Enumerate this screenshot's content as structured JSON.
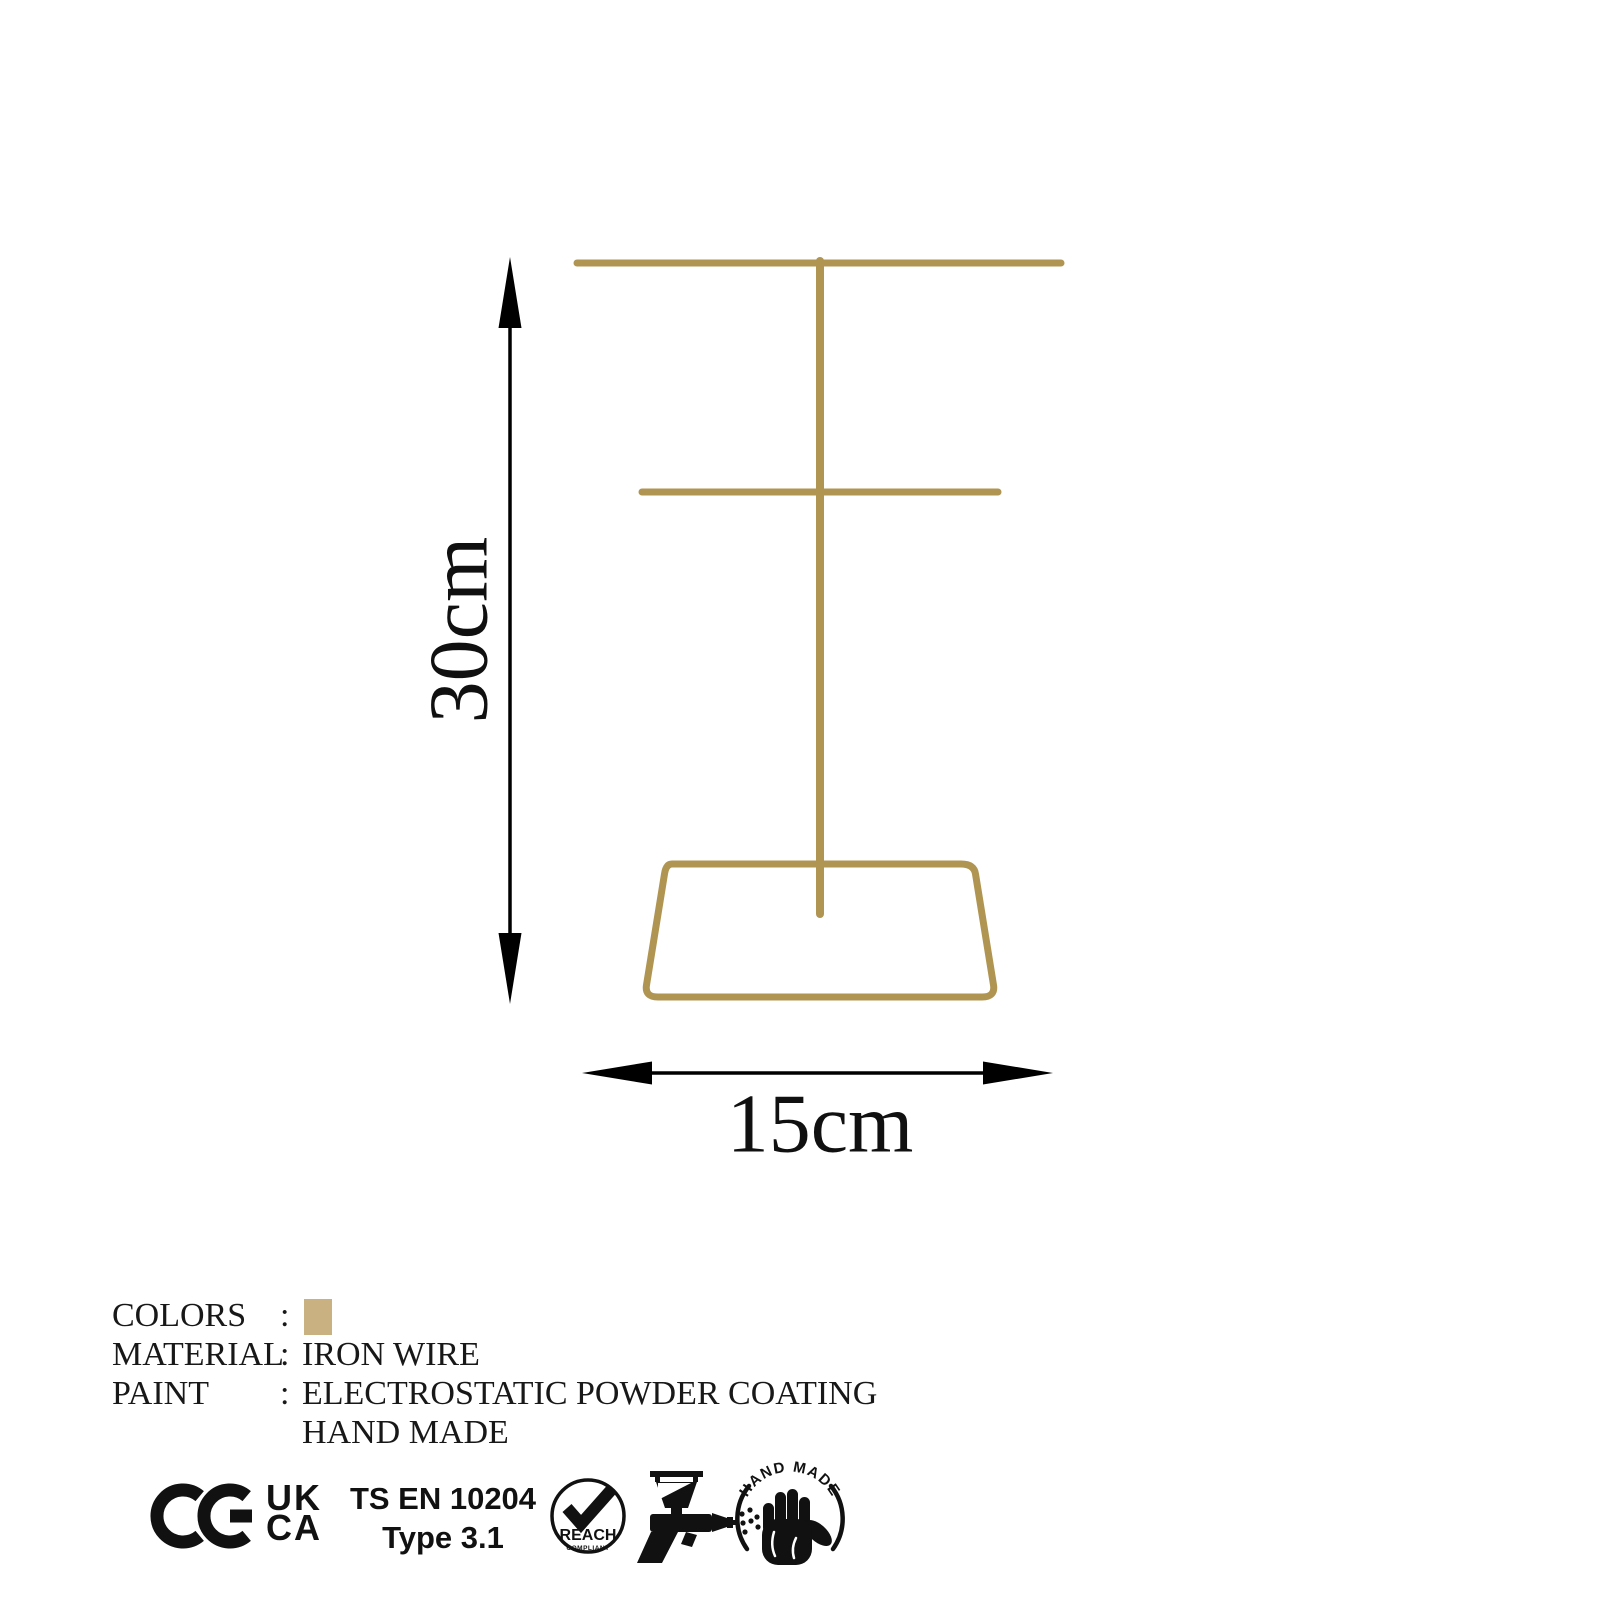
{
  "page": {
    "background": "#ffffff"
  },
  "product": {
    "name": "jewelry stand wire frame",
    "gold_color": "#b09552",
    "dimensions": {
      "height_label": "30cm",
      "width_label": "15cm"
    }
  },
  "specs": {
    "rows": [
      {
        "label": "COLORS",
        "separator": ":",
        "value": "",
        "swatch_color": "#c9b181"
      },
      {
        "label": "MATERIAL",
        "separator": ":",
        "value": "IRON WIRE"
      },
      {
        "label": "PAINT",
        "separator": ":",
        "value": "ELECTROSTATIC POWDER COATING"
      },
      {
        "label": "",
        "separator": "",
        "value": "HAND MADE"
      }
    ]
  },
  "certifications": {
    "ce_icon": "CE",
    "ukca_line1": "UK",
    "ukca_line2": "CA",
    "standard_line1": "TS EN 10204",
    "standard_line2": "Type 3.1",
    "reach_label": "REACH",
    "reach_sublabel": "COMPLIANT",
    "handmade_badge_text": "HAND MADE",
    "icon_color": "#111111"
  }
}
